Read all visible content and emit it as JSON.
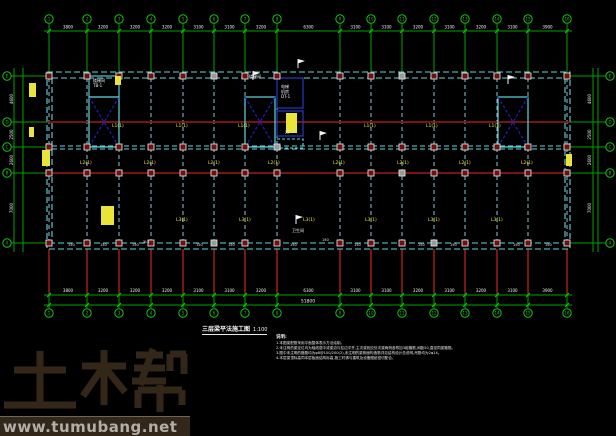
{
  "drawing": {
    "title": "三层梁平法施工图",
    "scale": "1:100",
    "notes_header": "说明:",
    "notes": [
      "1.本图梁配筋采用平面整体表示方法绘制。",
      "2.未注明的梁定位均为轴线居中或梁边与柱边平齐,主次梁相交处次梁两侧各附加3组箍筋,间距50,直径同梁箍筋。",
      "3.图中未注明的箍筋均为φ8@100/200(2),未注明的梁侧面构造筋详见结构设计总说明,吊筋均为2φ14。",
      "4.本层梁顶标高同本层板面结构标高,施工时请与建筑及设备图纸密切配合。"
    ]
  },
  "watermark": {
    "logo": "土木帮",
    "url": "www.tumubang.net"
  },
  "colors": {
    "green": "#00a400",
    "greenBright": "#17c417",
    "cyan": "#5ed7e0",
    "cyanBeam": "#7fc8ce",
    "navy": "#1f1fbe",
    "blue": "#2d3fd4",
    "maroon": "#8a1616",
    "colFill": "#6e1010",
    "colStroke": "#dcdcdc",
    "gray": "#9a9a9a",
    "yellow": "#e8e43a",
    "white": "#f2f2f2",
    "brown": "#33271a"
  },
  "plan": {
    "col_axes": [
      {
        "label": "1",
        "x": 49
      },
      {
        "label": "2",
        "x": 87
      },
      {
        "label": "3",
        "x": 119
      },
      {
        "label": "4",
        "x": 151
      },
      {
        "label": "5",
        "x": 183
      },
      {
        "label": "6",
        "x": 214
      },
      {
        "label": "7",
        "x": 245
      },
      {
        "label": "8",
        "x": 277
      },
      {
        "label": "9",
        "x": 340
      },
      {
        "label": "10",
        "x": 371
      },
      {
        "label": "11",
        "x": 402
      },
      {
        "label": "12",
        "x": 434
      },
      {
        "label": "13",
        "x": 465
      },
      {
        "label": "14",
        "x": 497
      },
      {
        "label": "15",
        "x": 528
      },
      {
        "label": "16",
        "x": 567
      }
    ],
    "row_axes": [
      {
        "label": "E",
        "y": 76
      },
      {
        "label": "D",
        "y": 122
      },
      {
        "label": "C",
        "y": 147
      },
      {
        "label": "B",
        "y": 173
      },
      {
        "label": "A",
        "y": 243
      }
    ],
    "top_dims": [
      "3800",
      "3200",
      "3200",
      "3200",
      "3100",
      "3100",
      "3200",
      "6300",
      "3100",
      "3100",
      "3200",
      "3100",
      "3200",
      "3100",
      "3900"
    ],
    "bottom_dims": [
      "3800",
      "3200",
      "3200",
      "3200",
      "3100",
      "3100",
      "3200",
      "6300",
      "3100",
      "3100",
      "3200",
      "3100",
      "3200",
      "3100",
      "3900"
    ],
    "bottom_total": "51800",
    "left_dims": [
      "4600",
      "2500",
      "2600",
      "7000"
    ],
    "right_dims": [
      "4600",
      "2500",
      "2600",
      "7000"
    ],
    "building": {
      "x1": 47,
      "y1": 72,
      "x2": 570,
      "y2": 249
    },
    "column_rows": [
      76,
      147,
      173,
      243
    ],
    "gray_columns": [
      [
        214,
        76
      ],
      [
        214,
        243
      ],
      [
        402,
        76
      ],
      [
        402,
        173
      ],
      [
        434,
        243
      ],
      [
        277,
        147
      ]
    ],
    "shafts": [
      {
        "x": 89,
        "y": 97,
        "w": 30,
        "h": 50
      },
      {
        "x": 245,
        "y": 97,
        "w": 30,
        "h": 50
      },
      {
        "x": 498,
        "y": 97,
        "w": 30,
        "h": 50
      }
    ],
    "rooms": [
      {
        "x": 89,
        "y": 76,
        "w": 30,
        "h": 21,
        "style": "cyan"
      },
      {
        "x": 277,
        "y": 78,
        "w": 26,
        "h": 30,
        "style": "blue"
      },
      {
        "x": 277,
        "y": 111,
        "w": 26,
        "h": 25,
        "style": "blue"
      },
      {
        "x": 277,
        "y": 139,
        "w": 26,
        "h": 9,
        "style": "cyanDash"
      }
    ],
    "yellow_blobs": [
      {
        "x": 286,
        "y": 113,
        "w": 11,
        "h": 20
      },
      {
        "x": 101,
        "y": 206,
        "w": 13,
        "h": 19
      },
      {
        "x": 29,
        "y": 83,
        "w": 7,
        "h": 14
      },
      {
        "x": 115,
        "y": 76,
        "w": 6,
        "h": 9
      },
      {
        "x": 29,
        "y": 127,
        "w": 5,
        "h": 10
      },
      {
        "x": 42,
        "y": 150,
        "w": 8,
        "h": 16
      },
      {
        "x": 566,
        "y": 154,
        "w": 6,
        "h": 12
      }
    ],
    "yellow_tags": [
      {
        "x": 112,
        "y": 127,
        "t": "L1(1)"
      },
      {
        "x": 176,
        "y": 127,
        "t": "L1(1)"
      },
      {
        "x": 238,
        "y": 127,
        "t": "L1(1)"
      },
      {
        "x": 364,
        "y": 127,
        "t": "L1(1)"
      },
      {
        "x": 426,
        "y": 127,
        "t": "L1(1)"
      },
      {
        "x": 489,
        "y": 127,
        "t": "L1(1)"
      },
      {
        "x": 80,
        "y": 164,
        "t": "L2(1)"
      },
      {
        "x": 144,
        "y": 164,
        "t": "L2(1)"
      },
      {
        "x": 208,
        "y": 164,
        "t": "L2(1)"
      },
      {
        "x": 268,
        "y": 164,
        "t": "L2(1)"
      },
      {
        "x": 333,
        "y": 164,
        "t": "L2(1)"
      },
      {
        "x": 397,
        "y": 164,
        "t": "L2(1)"
      },
      {
        "x": 459,
        "y": 164,
        "t": "L2(1)"
      },
      {
        "x": 521,
        "y": 164,
        "t": "L2(1)"
      },
      {
        "x": 176,
        "y": 221,
        "t": "L3(1)"
      },
      {
        "x": 239,
        "y": 221,
        "t": "L3(1)"
      },
      {
        "x": 303,
        "y": 221,
        "t": "L3(1)"
      },
      {
        "x": 365,
        "y": 221,
        "t": "L3(1)"
      },
      {
        "x": 428,
        "y": 221,
        "t": "L3(1)"
      },
      {
        "x": 491,
        "y": 221,
        "t": "L3(1)"
      }
    ],
    "white_tags": [
      {
        "x": 68,
        "y": 246,
        "t": "150"
      },
      {
        "x": 100,
        "y": 246,
        "t": "150"
      },
      {
        "x": 132,
        "y": 246,
        "t": "150"
      },
      {
        "x": 196,
        "y": 246,
        "t": "150"
      },
      {
        "x": 228,
        "y": 246,
        "t": "150"
      },
      {
        "x": 290,
        "y": 246,
        "t": "150"
      },
      {
        "x": 322,
        "y": 241,
        "t": "150"
      },
      {
        "x": 354,
        "y": 246,
        "t": "150"
      },
      {
        "x": 418,
        "y": 246,
        "t": "150"
      },
      {
        "x": 450,
        "y": 246,
        "t": "150"
      },
      {
        "x": 513,
        "y": 246,
        "t": "150"
      },
      {
        "x": 545,
        "y": 246,
        "t": "150"
      },
      {
        "x": 143,
        "y": 243,
        "t": "XL1"
      }
    ],
    "room_labels": [
      {
        "x": 93,
        "y": 82,
        "t": "楼梯间"
      },
      {
        "x": 93,
        "y": 87,
        "t": "TB-1"
      },
      {
        "x": 249,
        "y": 78,
        "t": "楼梯间"
      },
      {
        "x": 281,
        "y": 88,
        "t": "电梯"
      },
      {
        "x": 281,
        "y": 93,
        "t": "机房"
      },
      {
        "x": 281,
        "y": 98,
        "t": "DT-1"
      },
      {
        "x": 285,
        "y": 134,
        "t": "XT"
      },
      {
        "x": 292,
        "y": 232,
        "t": "卫生间"
      }
    ],
    "flags": [
      {
        "x": 253,
        "y": 80
      },
      {
        "x": 298,
        "y": 68
      },
      {
        "x": 508,
        "y": 84
      },
      {
        "x": 320,
        "y": 140
      },
      {
        "x": 296,
        "y": 224
      }
    ]
  }
}
